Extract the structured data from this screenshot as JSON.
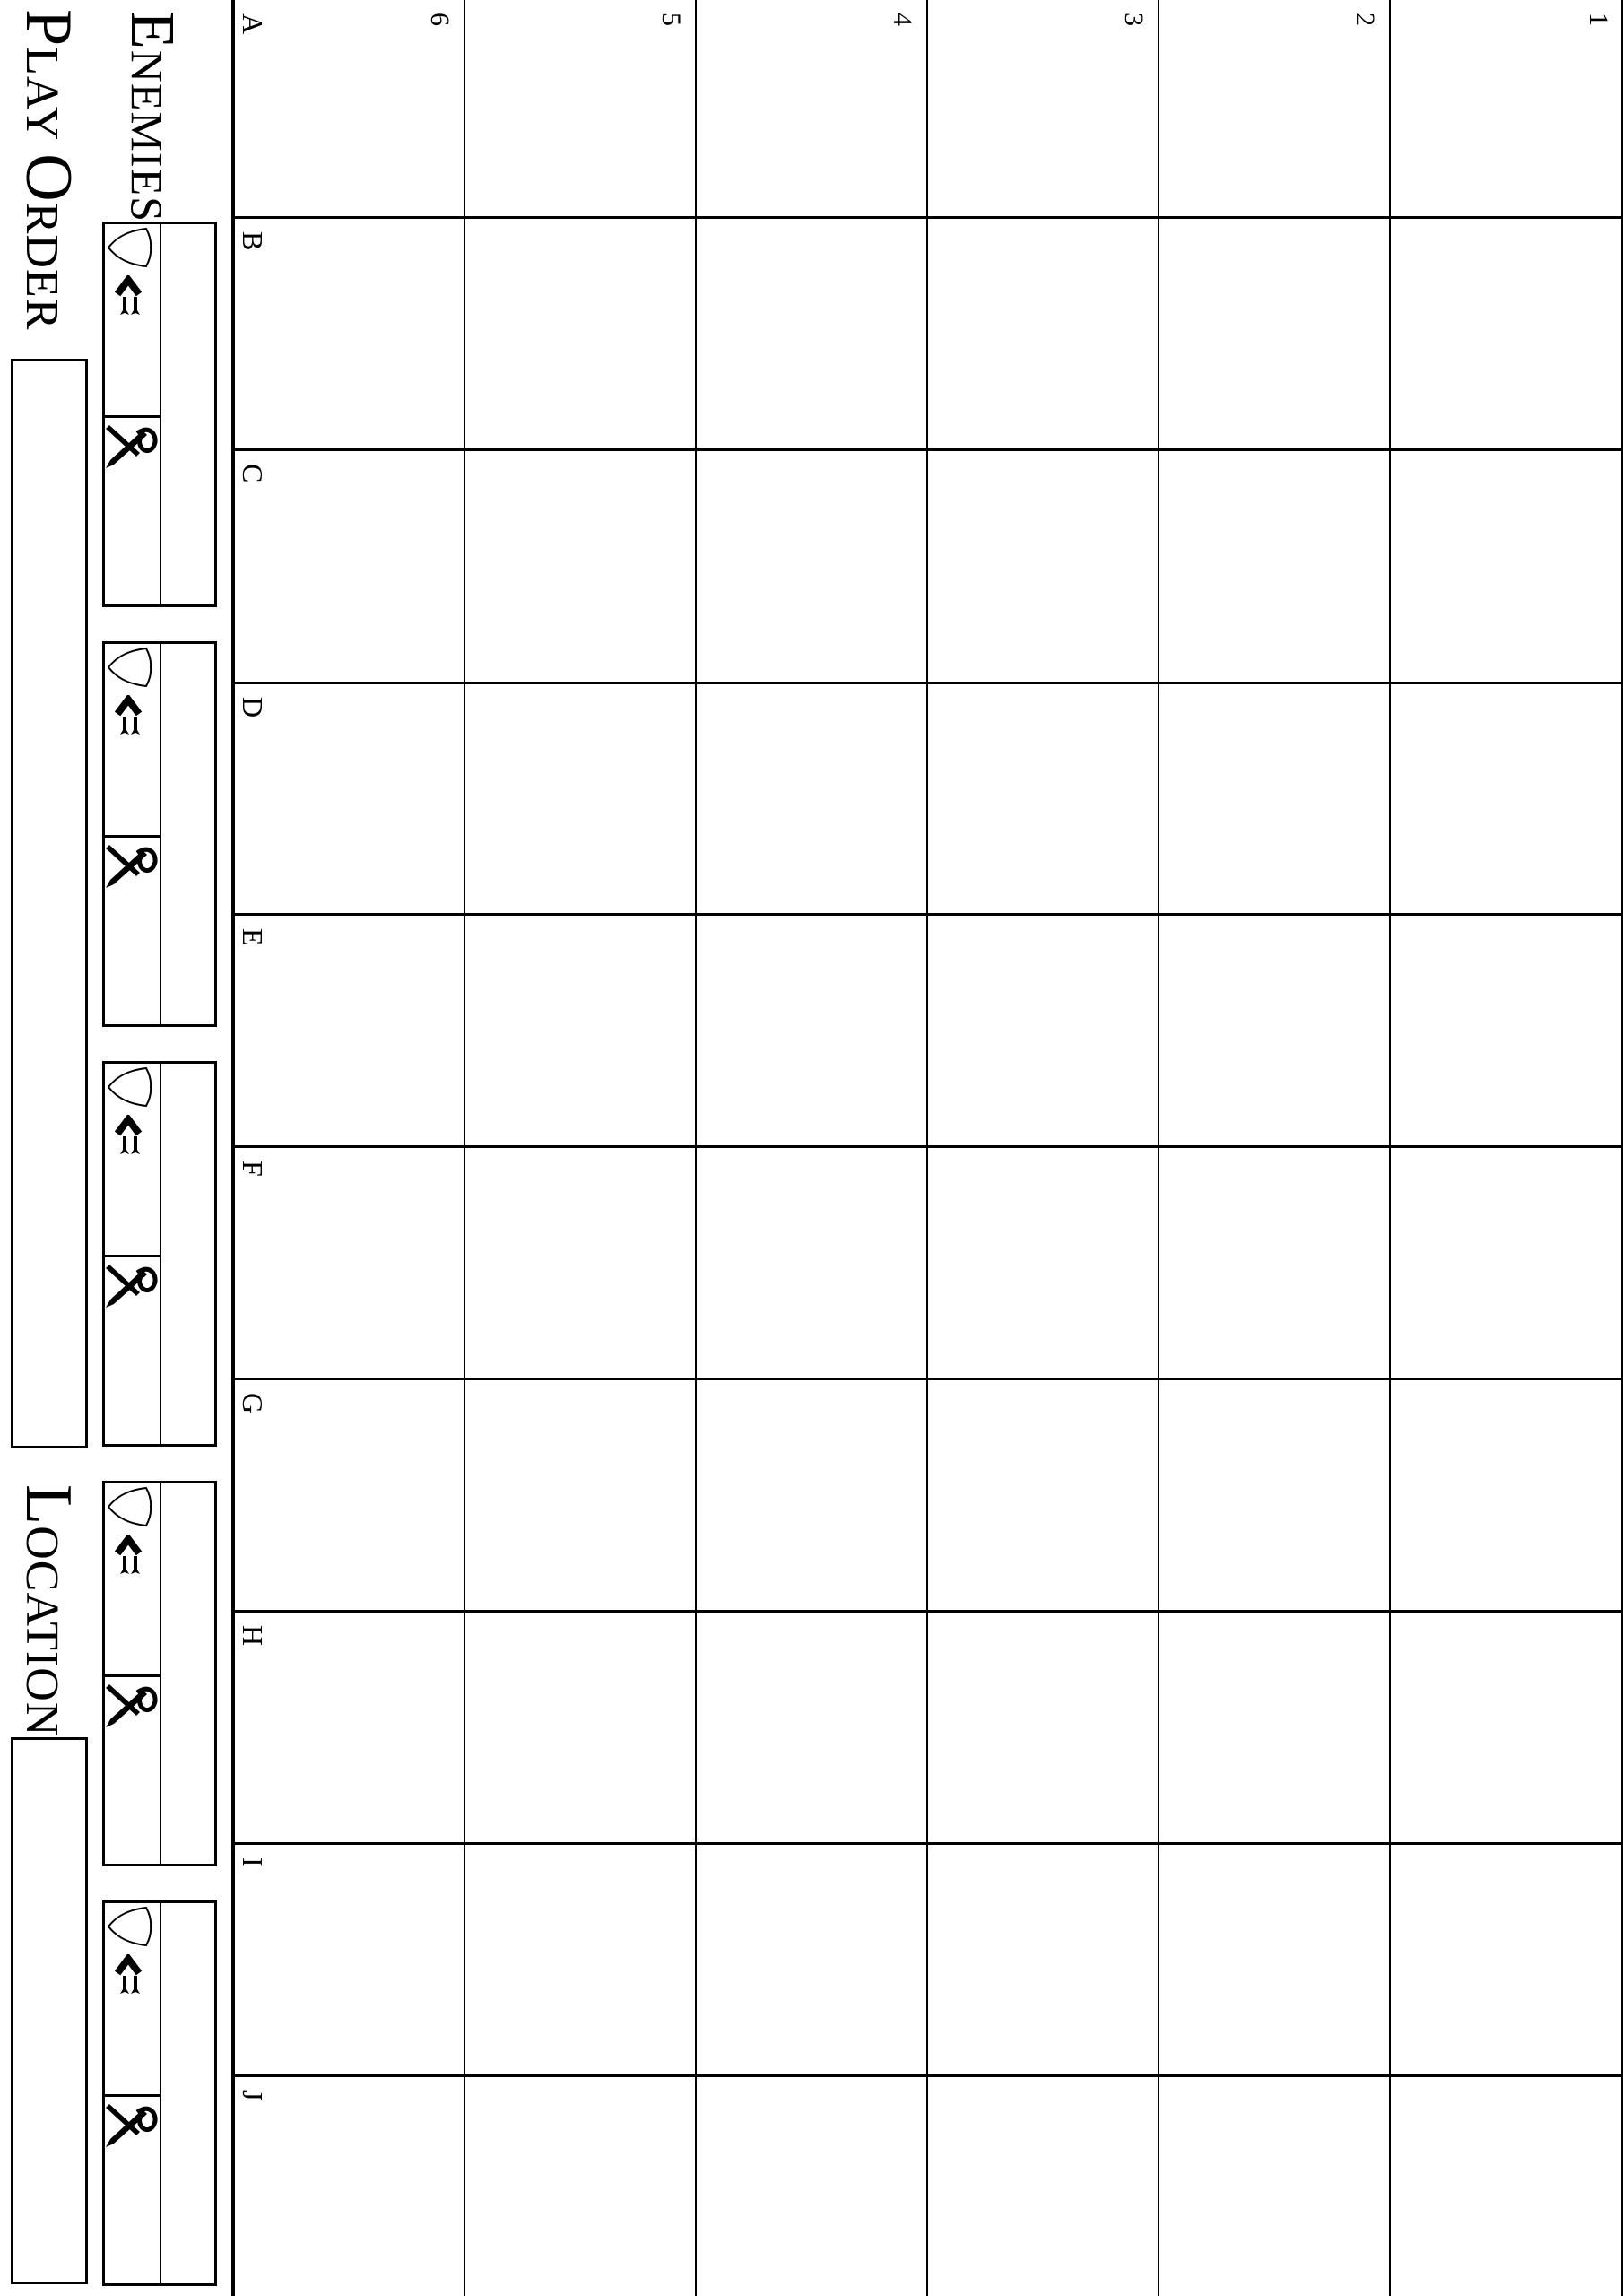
{
  "colors": {
    "paper": "#ffffff",
    "ink": "#000000"
  },
  "titles": {
    "enemies": {
      "cap": "E",
      "rest": "NEMIES"
    },
    "play_order": {
      "cap1": "P",
      "rest1": "LAY",
      "cap2": "O",
      "rest2": "RDER"
    },
    "location": {
      "cap": "L",
      "rest": "OCATION"
    }
  },
  "grid": {
    "column_labels": [
      "A",
      "B",
      "C",
      "D",
      "E",
      "F",
      "G",
      "H",
      "I",
      "J"
    ],
    "row_labels": [
      "1",
      "2",
      "3",
      "4",
      "5",
      "6"
    ],
    "columns": 10,
    "rows": 6
  },
  "enemy_panel": {
    "box_count": 5,
    "icons": [
      "shield-icon",
      "speed-arrow-icon",
      "attack-sword-icon"
    ]
  }
}
